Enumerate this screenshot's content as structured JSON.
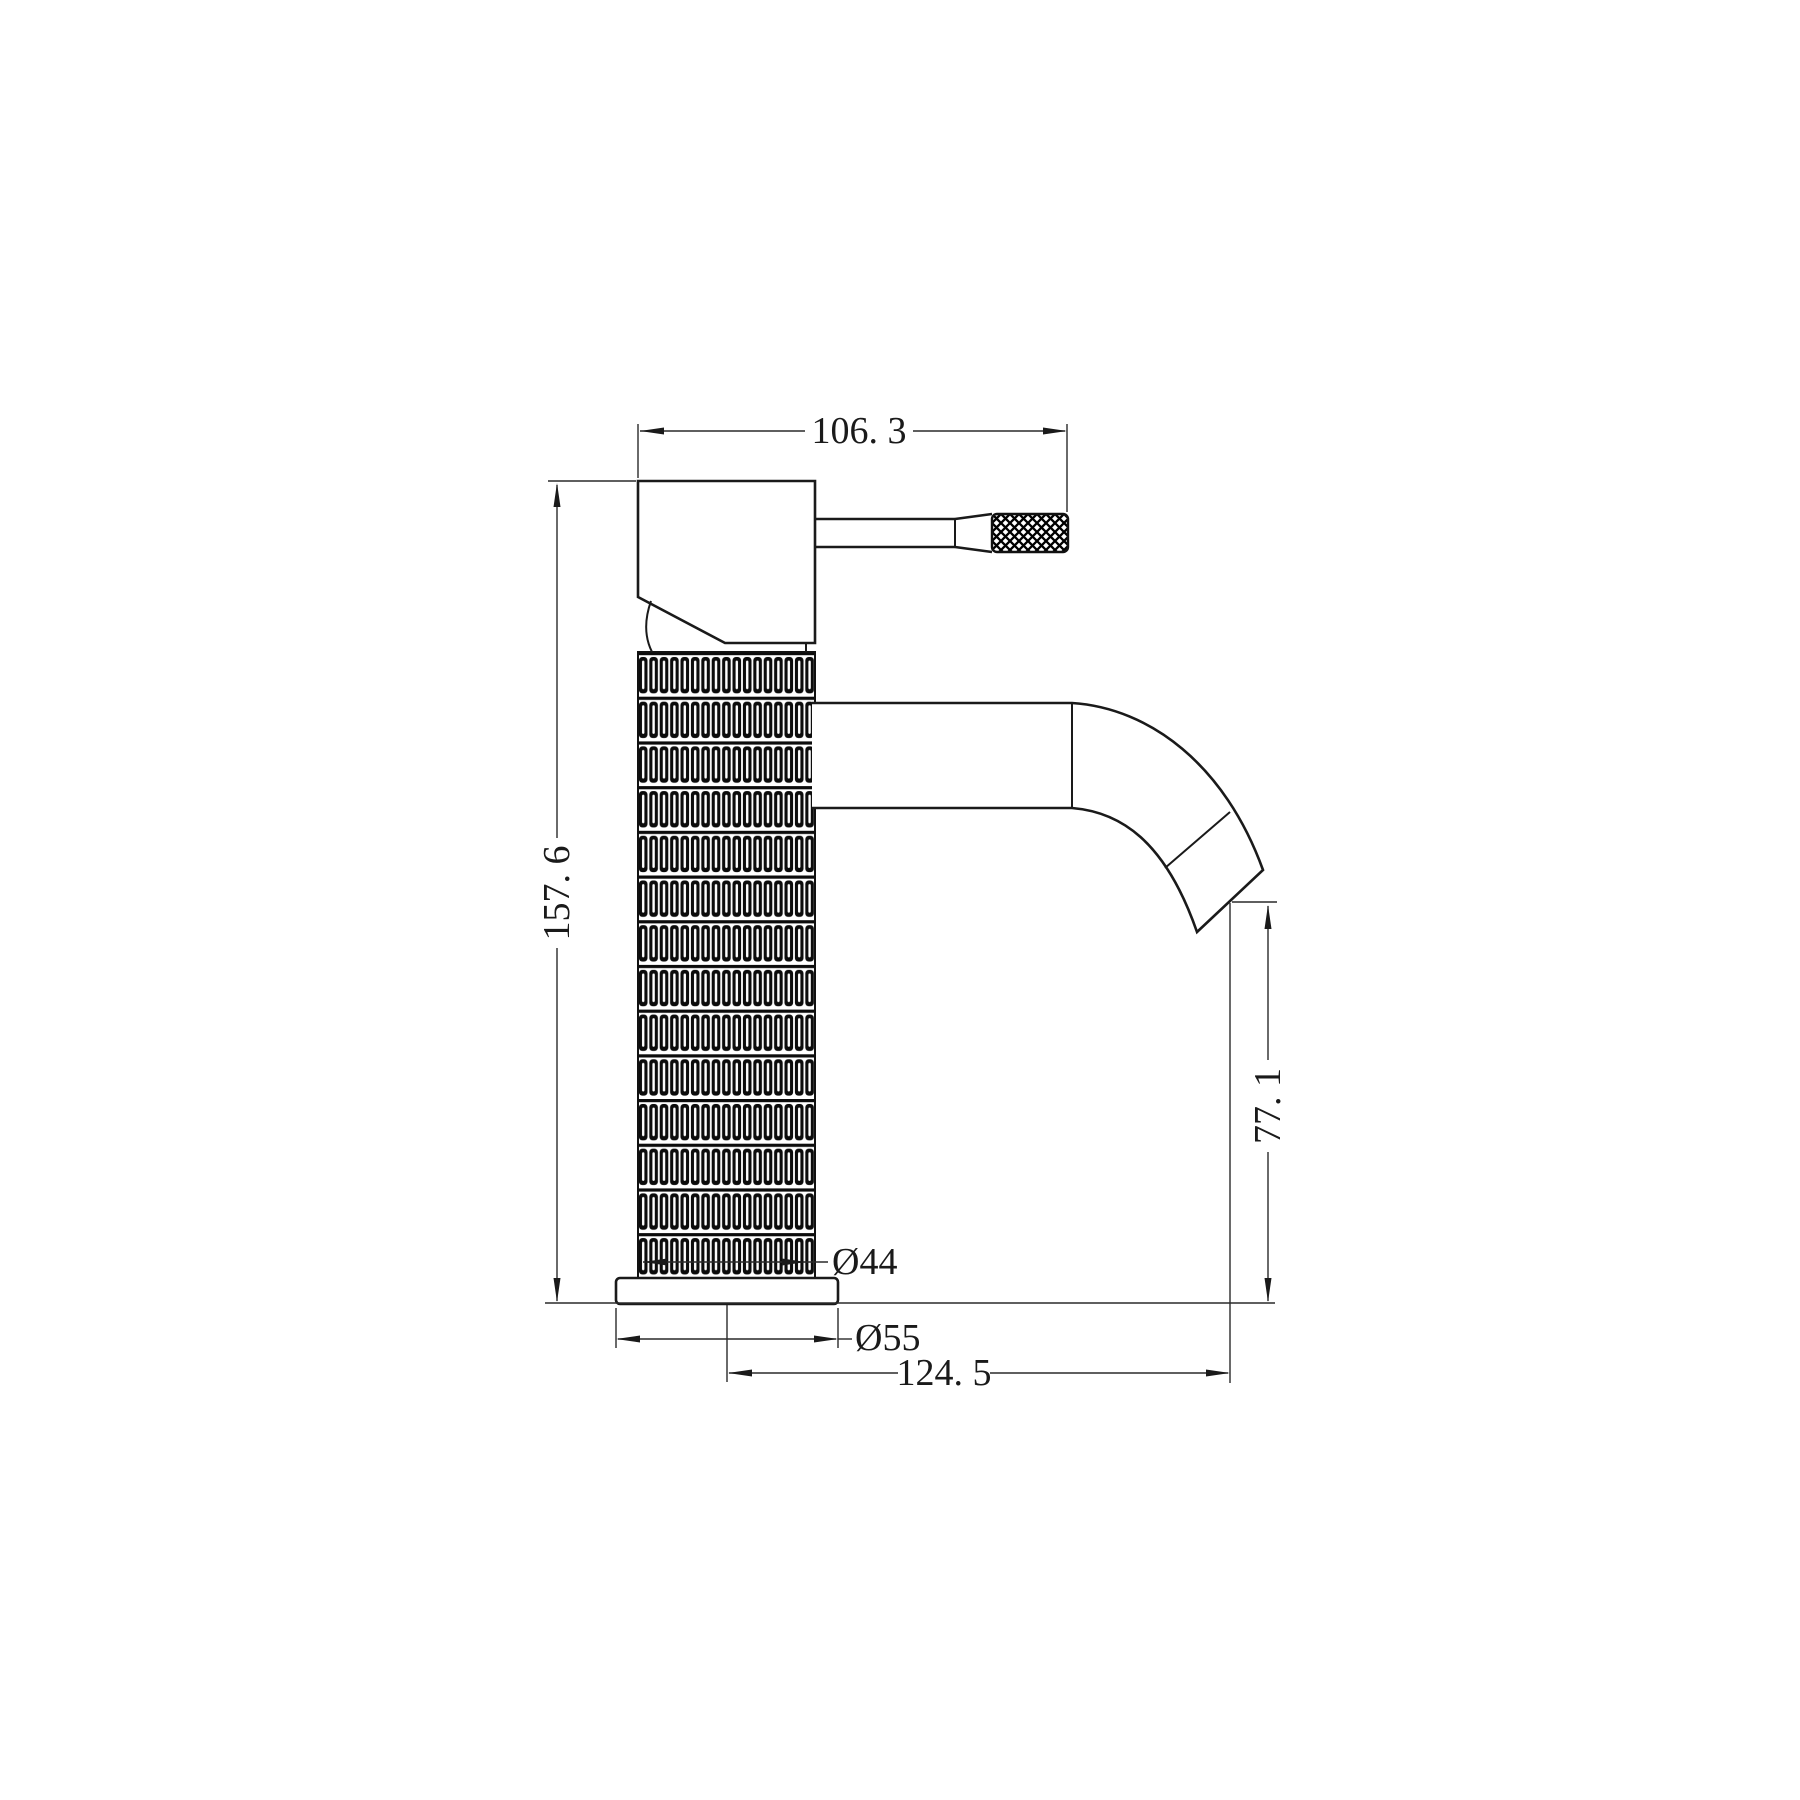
{
  "page": {
    "background_color": "#ffffff",
    "line_color": "#1a1a1a",
    "dimension_line_color": "#2a2a2a"
  },
  "drawing": {
    "type": "technical-drawing",
    "subject": "single-lever basin mixer tap, side elevation",
    "dim_labels": {
      "top_width": "106. 3",
      "overall_height": "157. 6",
      "spout_outlet_height": "77. 1",
      "body_diameter": "Ø44",
      "base_diameter": "Ø55",
      "spout_reach": "124. 5"
    }
  }
}
